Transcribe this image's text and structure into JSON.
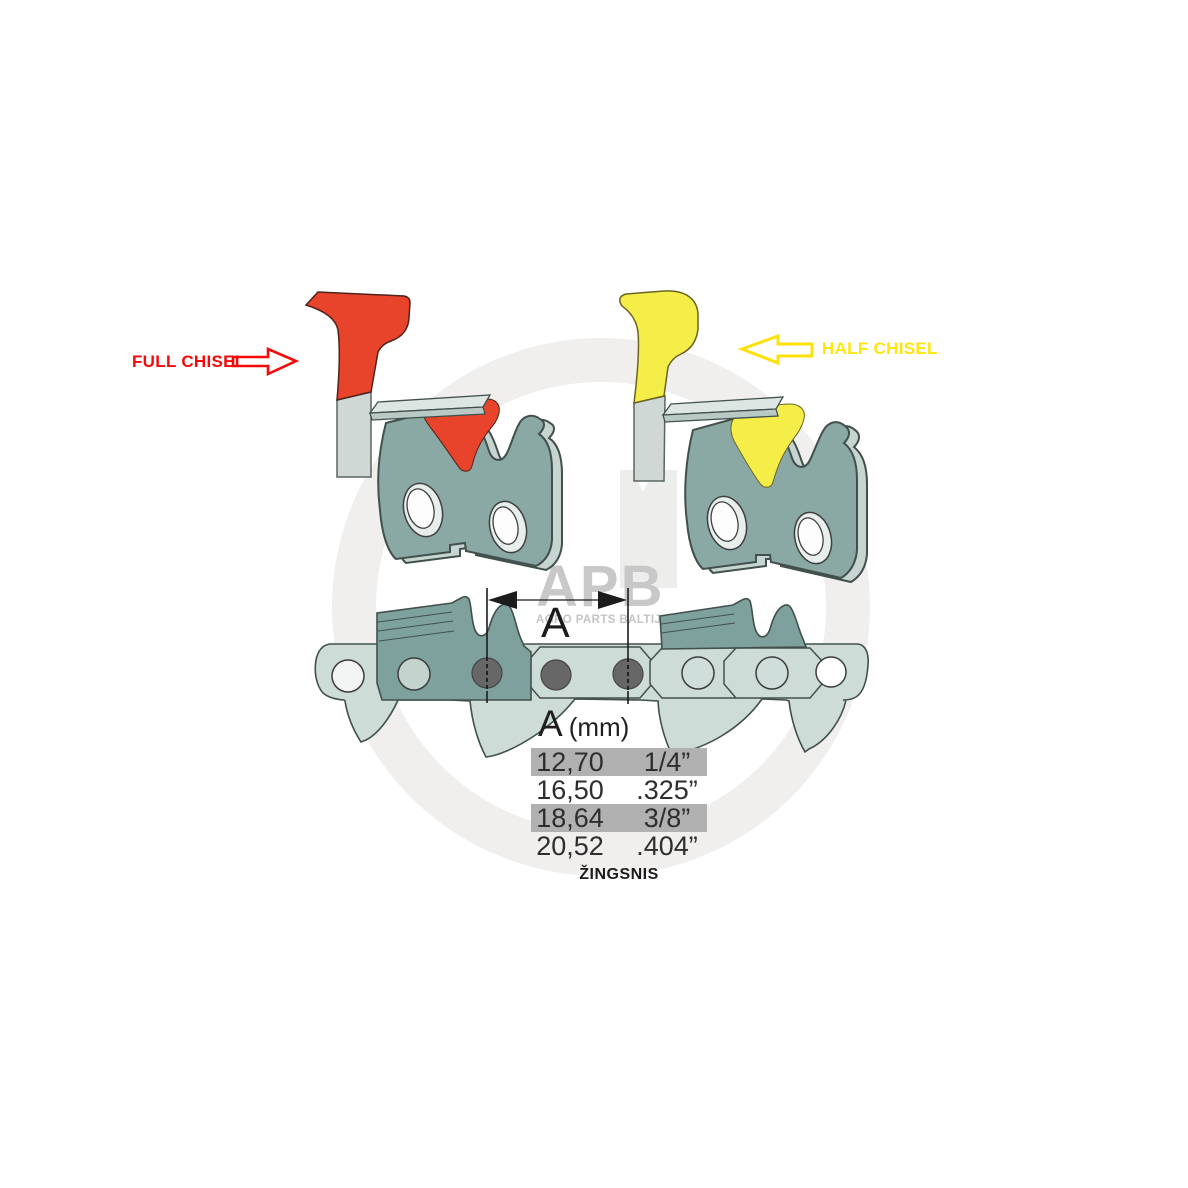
{
  "subject": "chainsaw chain pitch diagram",
  "background": "#ffffff",
  "annotations": {
    "full_chisel": {
      "label": "FULL CHISEL",
      "label_color": "#f60909",
      "accent_color": "#e8432b",
      "arrow_icon": "block-arrow-right"
    },
    "half_chisel": {
      "label": "HALF CHISEL",
      "label_color": "#ffe50c",
      "accent_color": "#f5ee48",
      "arrow_icon": "block-arrow-left"
    }
  },
  "dimension": {
    "letter": "A",
    "style": "double-headed-arrow-between-rivets"
  },
  "pitch_table": {
    "header": {
      "letter": "A",
      "unit": "(mm)"
    },
    "highlight_color": "#b1b1b1",
    "rows": [
      {
        "mm": "12,70",
        "inches": "1/4”",
        "highlighted": true
      },
      {
        "mm": "16,50",
        "inches": ".325”",
        "highlighted": false
      },
      {
        "mm": "18,64",
        "inches": "3/8”",
        "highlighted": true
      },
      {
        "mm": "20,52",
        "inches": ".404”",
        "highlighted": false
      }
    ],
    "caption": "ŽINGSNIS"
  },
  "watermark": {
    "logo": "APB",
    "subtitle": "AGRO PARTS BALTIJA",
    "color": "#c9c8c8"
  },
  "palette": {
    "link_light": "#cddcd7",
    "cutter_body": "#8aa8a4",
    "chain_cutter": "#7fa19d",
    "edge_light": "#c6d5d1",
    "plate_light": "#dde6e3",
    "rivet_gray": "#676767",
    "outline": "#42504c",
    "watermark_ring": "#f0efee"
  }
}
